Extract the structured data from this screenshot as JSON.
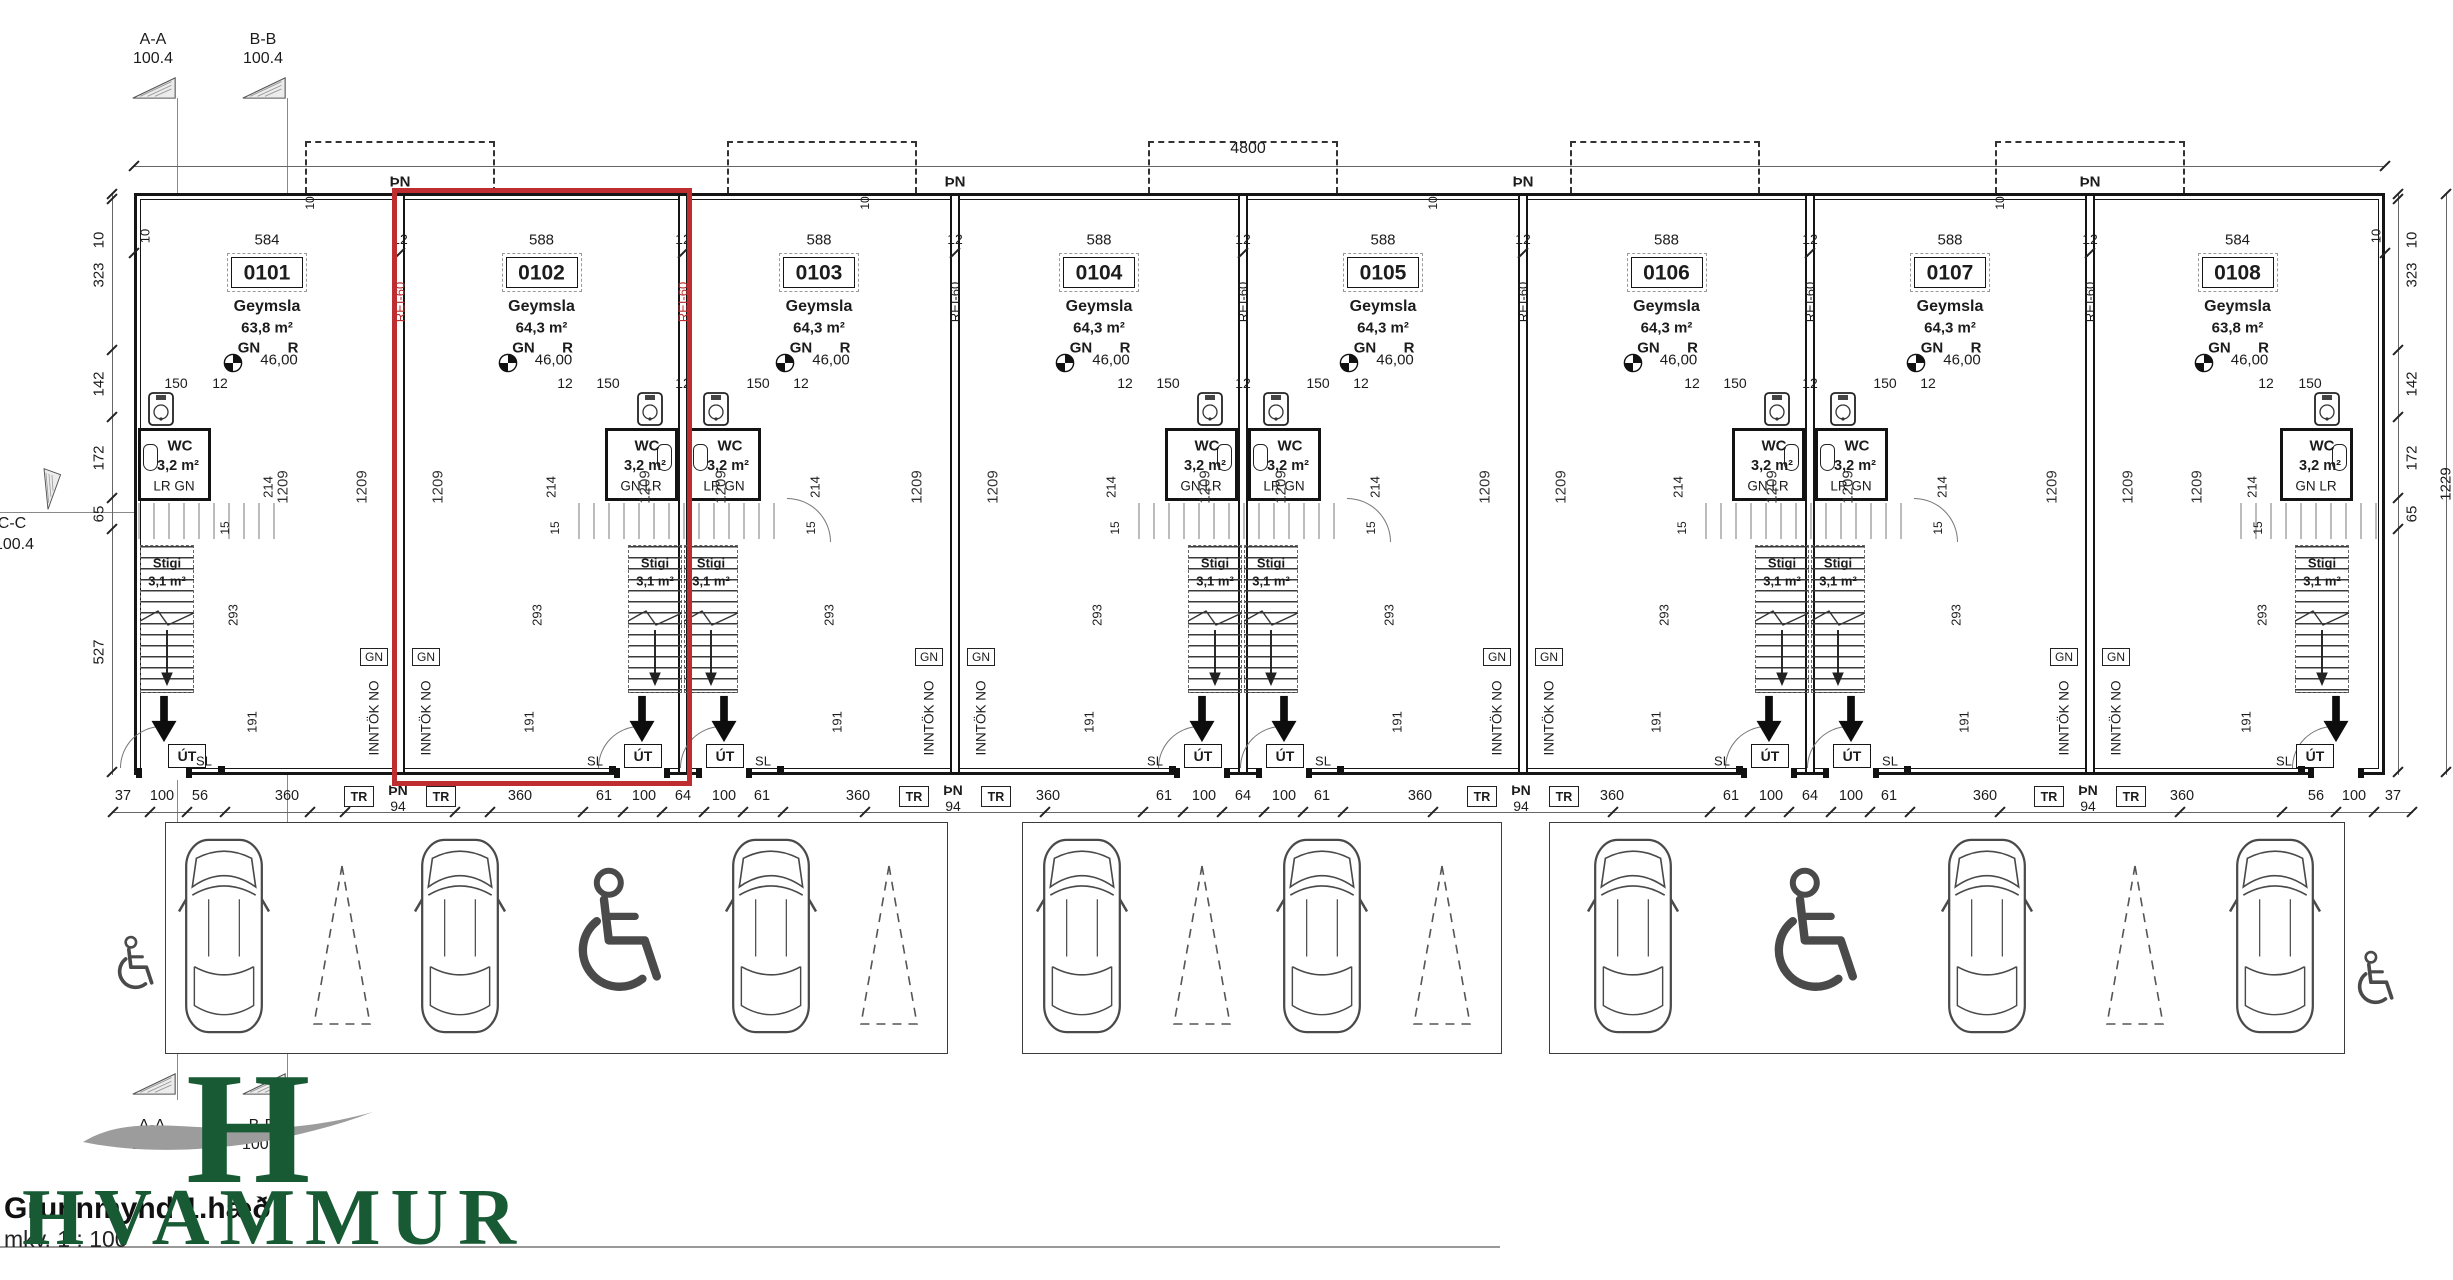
{
  "title_block": {
    "title": "Grunnmynd 1.hæð",
    "scale_label": "mkv. 1 : 100"
  },
  "logo": {
    "monogram": "H",
    "wordmark": "HVAMMUR"
  },
  "colors": {
    "highlight_red": "#be2d30",
    "logo_green": "#185a34",
    "swoosh_gray": "#9c9c9c",
    "ink": "#1c1c1c"
  },
  "section_markers": {
    "top": [
      {
        "label": "A-A",
        "level": "100.4"
      },
      {
        "label": "B-B",
        "level": "100.4"
      }
    ],
    "left": {
      "label": "C-C",
      "level": "100.4"
    },
    "bottom": [
      {
        "label": "A-A",
        "level": "100.4"
      },
      {
        "label": "B-B",
        "level": "100.4"
      }
    ]
  },
  "overall_dims": {
    "total_width": "4800",
    "total_right_height": "1229",
    "corner": "10",
    "party": "12"
  },
  "left_dims": [
    "10",
    "323",
    "142",
    "172",
    "65",
    "527"
  ],
  "right_dims": [
    "10",
    "323",
    "142",
    "172",
    "65"
  ],
  "repeat_dims": {
    "depth": "1209",
    "wc_w": "150",
    "w12": "12",
    "wc_side": "214",
    "stair_h": "293",
    "door_side": "191",
    "landing": "15"
  },
  "party_wall": {
    "top": "ÞN",
    "fire": "REI-60",
    "gn": "GN",
    "intake": "INNTÖK NO",
    "tr": "TR",
    "pn_num": "94"
  },
  "door": {
    "exit": "ÚT",
    "sl": "SL"
  },
  "units": [
    {
      "number": "0101",
      "type": "Geymsla",
      "area": "63,8 m²",
      "gn": "GN",
      "r": "R",
      "level": "46,00",
      "width": "584",
      "wc": {
        "name": "WC",
        "area": "3,2 m²",
        "sub": "LR GN"
      },
      "stair": {
        "name": "Stigi",
        "area": "3,1 m²"
      },
      "highlighted": false
    },
    {
      "number": "0102",
      "type": "Geymsla",
      "area": "64,3 m²",
      "gn": "GN",
      "r": "R",
      "level": "46,00",
      "width": "588",
      "wc": {
        "name": "WC",
        "area": "3,2 m²",
        "sub": "GN LR"
      },
      "stair": {
        "name": "Stigi",
        "area": "3,1 m²"
      },
      "highlighted": true
    },
    {
      "number": "0103",
      "type": "Geymsla",
      "area": "64,3 m²",
      "gn": "GN",
      "r": "R",
      "level": "46,00",
      "width": "588",
      "wc": {
        "name": "WC",
        "area": "3,2 m²",
        "sub": "LR GN"
      },
      "stair": {
        "name": "Stigi",
        "area": "3,1 m²"
      },
      "highlighted": false
    },
    {
      "number": "0104",
      "type": "Geymsla",
      "area": "64,3 m²",
      "gn": "GN",
      "r": "R",
      "level": "46,00",
      "width": "588",
      "wc": {
        "name": "WC",
        "area": "3,2 m²",
        "sub": "GN LR"
      },
      "stair": {
        "name": "Stigi",
        "area": "3,1 m²"
      },
      "highlighted": false
    },
    {
      "number": "0105",
      "type": "Geymsla",
      "area": "64,3 m²",
      "gn": "GN",
      "r": "R",
      "level": "46,00",
      "width": "588",
      "wc": {
        "name": "WC",
        "area": "3,2 m²",
        "sub": "LR GN"
      },
      "stair": {
        "name": "Stigi",
        "area": "3,1 m²"
      },
      "highlighted": false
    },
    {
      "number": "0106",
      "type": "Geymsla",
      "area": "64,3 m²",
      "gn": "GN",
      "r": "R",
      "level": "46,00",
      "width": "588",
      "wc": {
        "name": "WC",
        "area": "3,2 m²",
        "sub": "GN LR"
      },
      "stair": {
        "name": "Stigi",
        "area": "3,1 m²"
      },
      "highlighted": false
    },
    {
      "number": "0107",
      "type": "Geymsla",
      "area": "64,3 m²",
      "gn": "GN",
      "r": "R",
      "level": "46,00",
      "width": "588",
      "wc": {
        "name": "WC",
        "area": "3,2 m²",
        "sub": "LR GN"
      },
      "stair": {
        "name": "Stigi",
        "area": "3,1 m²"
      },
      "highlighted": false
    },
    {
      "number": "0108",
      "type": "Geymsla",
      "area": "63,8 m²",
      "gn": "GN",
      "r": "R",
      "level": "46,00",
      "width": "584",
      "wc": {
        "name": "WC",
        "area": "3,2 m²",
        "sub": "GN LR"
      },
      "stair": {
        "name": "Stigi",
        "area": "3,1 m²"
      },
      "highlighted": false
    }
  ],
  "bottom_dims_sequence": [
    "37",
    "100",
    "56",
    "360",
    "360",
    "61",
    "100",
    "64",
    "100",
    "61",
    "360",
    "360",
    "61",
    "100",
    "64",
    "100",
    "61",
    "360",
    "360",
    "61",
    "100",
    "64",
    "100",
    "61",
    "360",
    "360",
    "56",
    "100",
    "37"
  ],
  "parking": {
    "groups": [
      [
        "car",
        "triangle",
        "car",
        "handicap",
        "car",
        "triangle"
      ],
      [
        "car",
        "triangle",
        "car",
        "triangle"
      ],
      [
        "car",
        "handicap",
        "car",
        "triangle",
        "car"
      ]
    ]
  }
}
